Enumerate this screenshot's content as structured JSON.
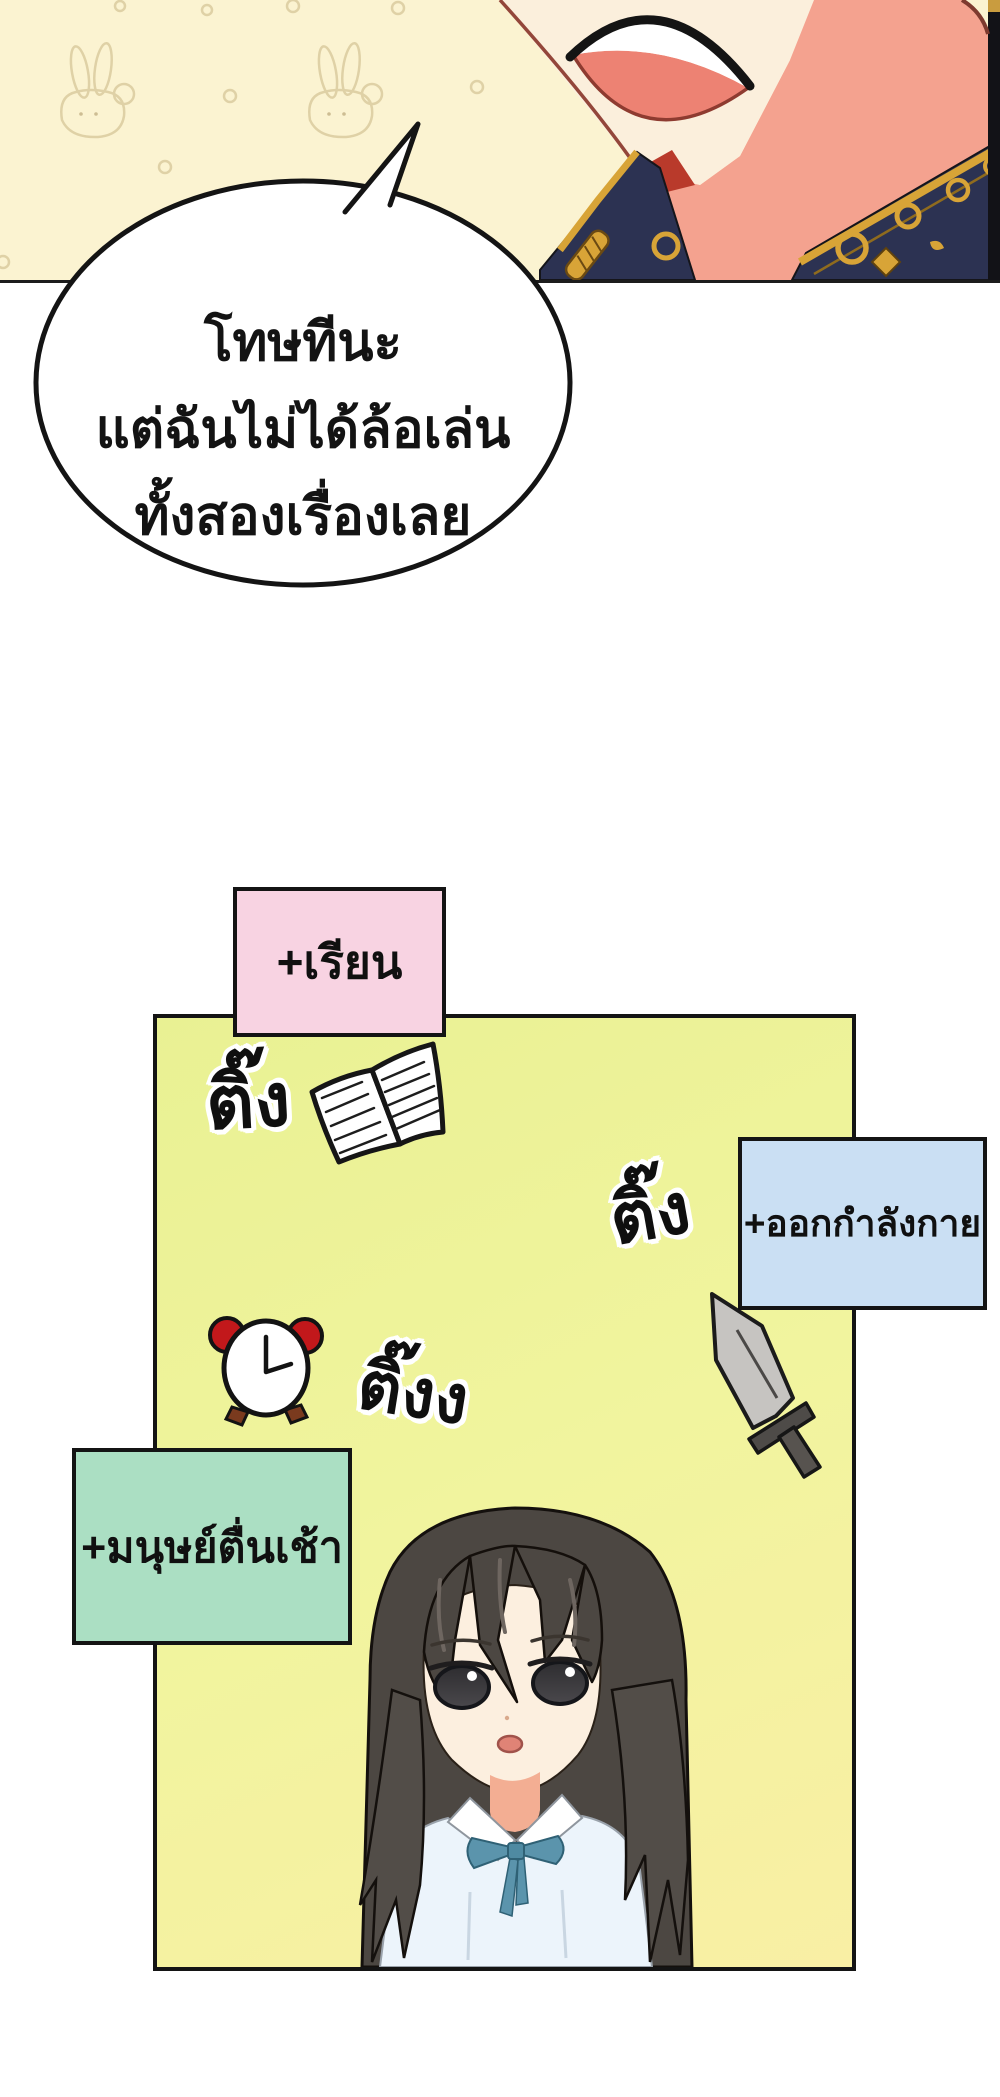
{
  "comic": {
    "speech_bubble": {
      "line1": "โทษทีนะ",
      "line2": "แต่ฉันไม่ได้ล้อเล่น",
      "line3": "ทั้งสองเรื่องเลย"
    },
    "status_tags": {
      "study": "+เรียน",
      "exercise": "+ออกกำลังกาย",
      "early_riser": "+มนุษย์ตื่นเช้า"
    },
    "sfx": {
      "ting_book": "ติ๊ง",
      "ting_sword": "ติ๊ง",
      "ting_clock": "ติ๊งง"
    },
    "colors": {
      "top_panel_bg": "#FBF3D1",
      "main_panel_top": "#E9F193",
      "main_panel_bottom": "#F9EFA4",
      "tag_pink": "#F8D3E2",
      "tag_blue": "#CADFF3",
      "tag_green": "#ABDFC3",
      "bubble_fill": "#FFFFFF",
      "outline": "#141414"
    }
  }
}
